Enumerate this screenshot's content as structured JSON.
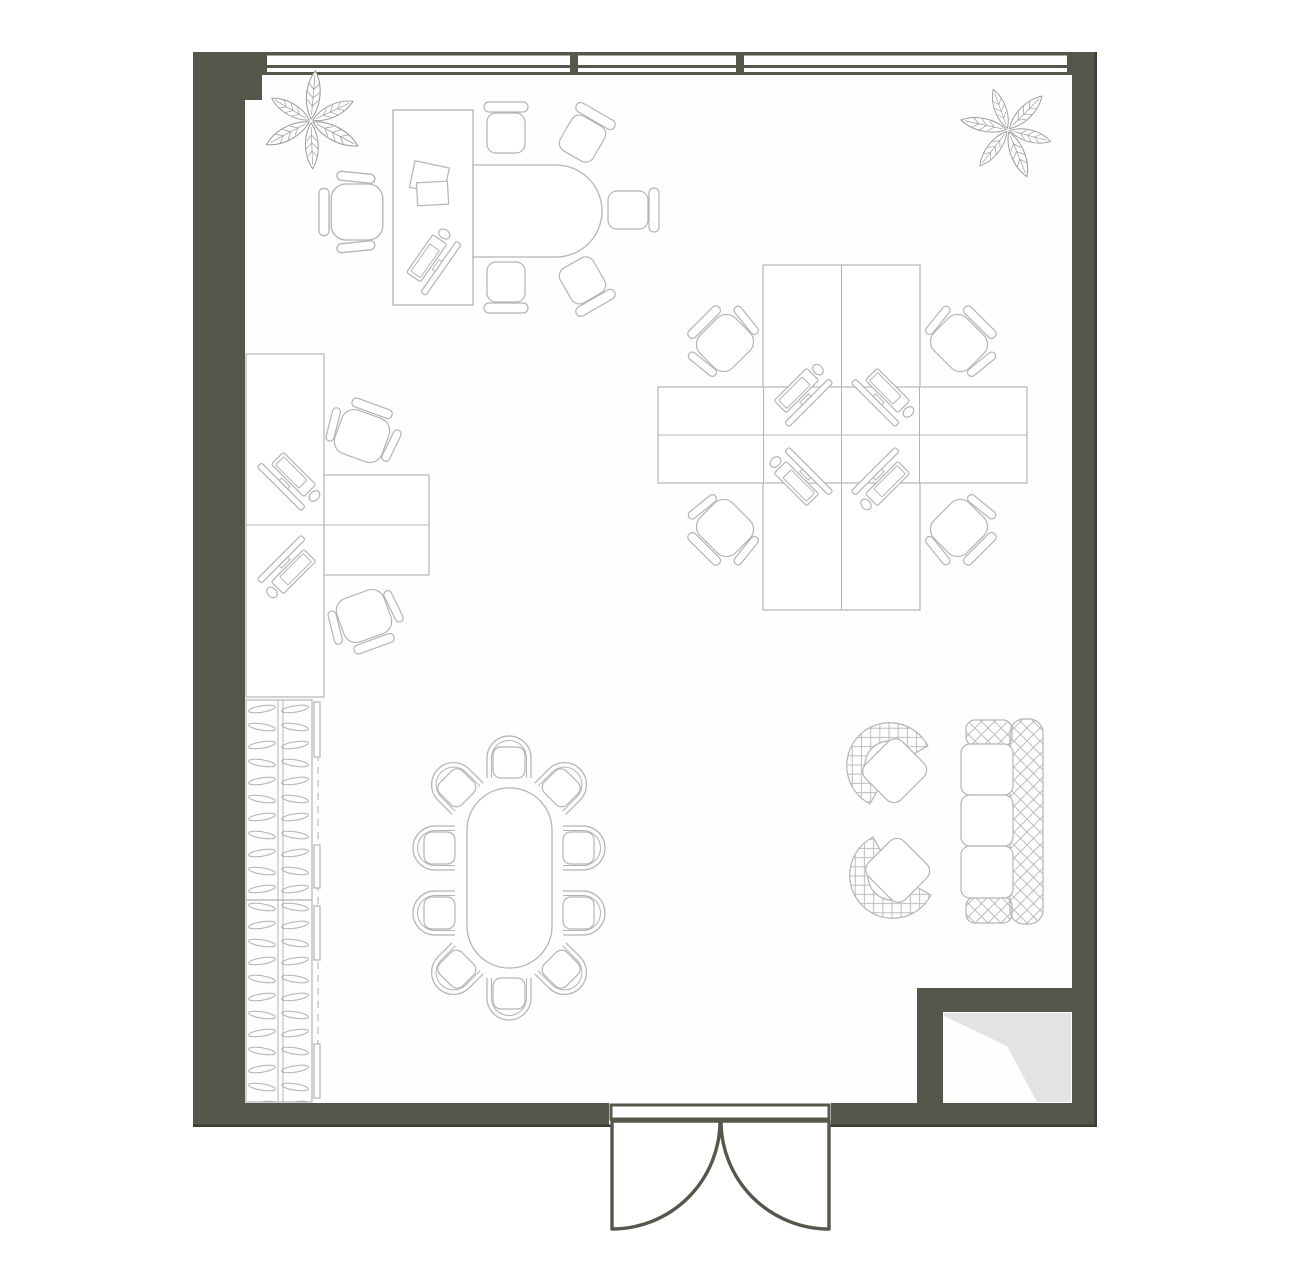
{
  "colors": {
    "wall": "#56564a",
    "wall_edge": "#3d3d33",
    "line": "#b4b4b4",
    "line_soft": "#c6c6c6",
    "leaf": "#9c9c9c",
    "floor": "#fefefe",
    "outside": "#ffffff",
    "shade": "#e3e3e3",
    "quilt": "#b6b6b6"
  },
  "inventory": {
    "window_segments": 3,
    "plants": 2,
    "entrance": "double swing door",
    "executive_area": {
      "desk": 1,
      "executive_chair": 1,
      "meeting_extension_table": 1,
      "visitor_chairs": 5,
      "paper_stacks": 2
    },
    "workstations": {
      "left_wall_desks": 2,
      "cluster_desks": 4,
      "task_chairs": 6,
      "computer_sets": 7
    },
    "wardrobe_units": 2,
    "conference": {
      "oval_table": 1,
      "chairs": 10
    },
    "lounge": {
      "sofa_seats": 3,
      "armchairs": 2
    },
    "utility_shaft": 1
  }
}
